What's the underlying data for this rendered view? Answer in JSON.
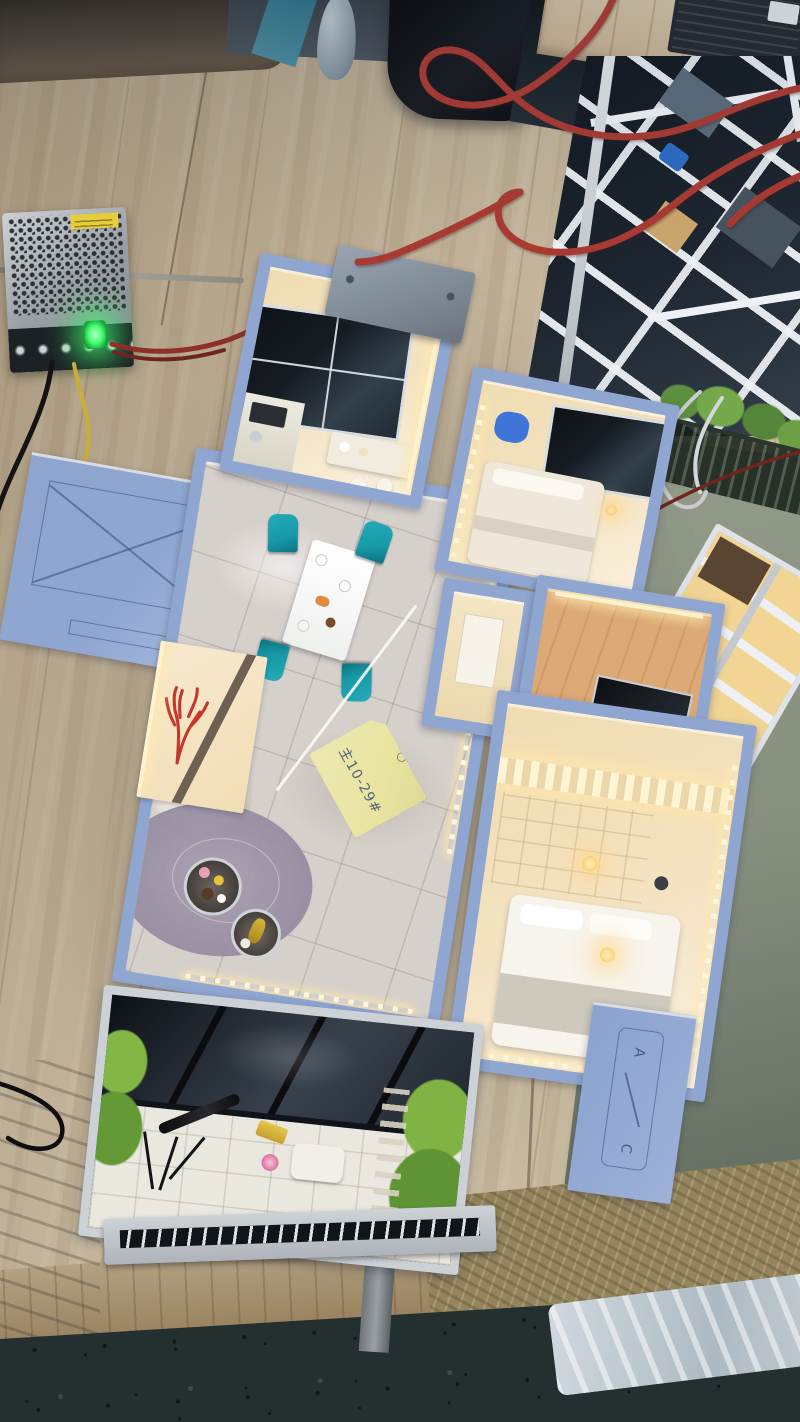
{
  "scene": {
    "type": "photograph",
    "subject": "illuminated apartment scale model on wooden workbench",
    "sticky_note": {
      "text": "主10-29#",
      "symbol": "○"
    },
    "wall_plaque": {
      "top_letter": "A",
      "bottom_letter": "C"
    }
  },
  "colors": {
    "table_wood": "#bfb096",
    "wall_blue": "#8fa6d1",
    "interior_warm": "#f4e3c2",
    "marble_floor": "#d6d0cb",
    "teal_chair": "#189aa8",
    "wood_floor": "#dba876",
    "dark_glass": "#161c23",
    "silver_trim": "#ccd1d6",
    "red_cable": "#a83a32",
    "led_green": "#46ff6e",
    "note_yellow": "#e9e4a0",
    "sage_wall": "#87907f",
    "dark_floor": "#243030",
    "plant_green": "#7fb343",
    "coral_red": "#c5372c",
    "bag_black": "#0a0a0c"
  }
}
